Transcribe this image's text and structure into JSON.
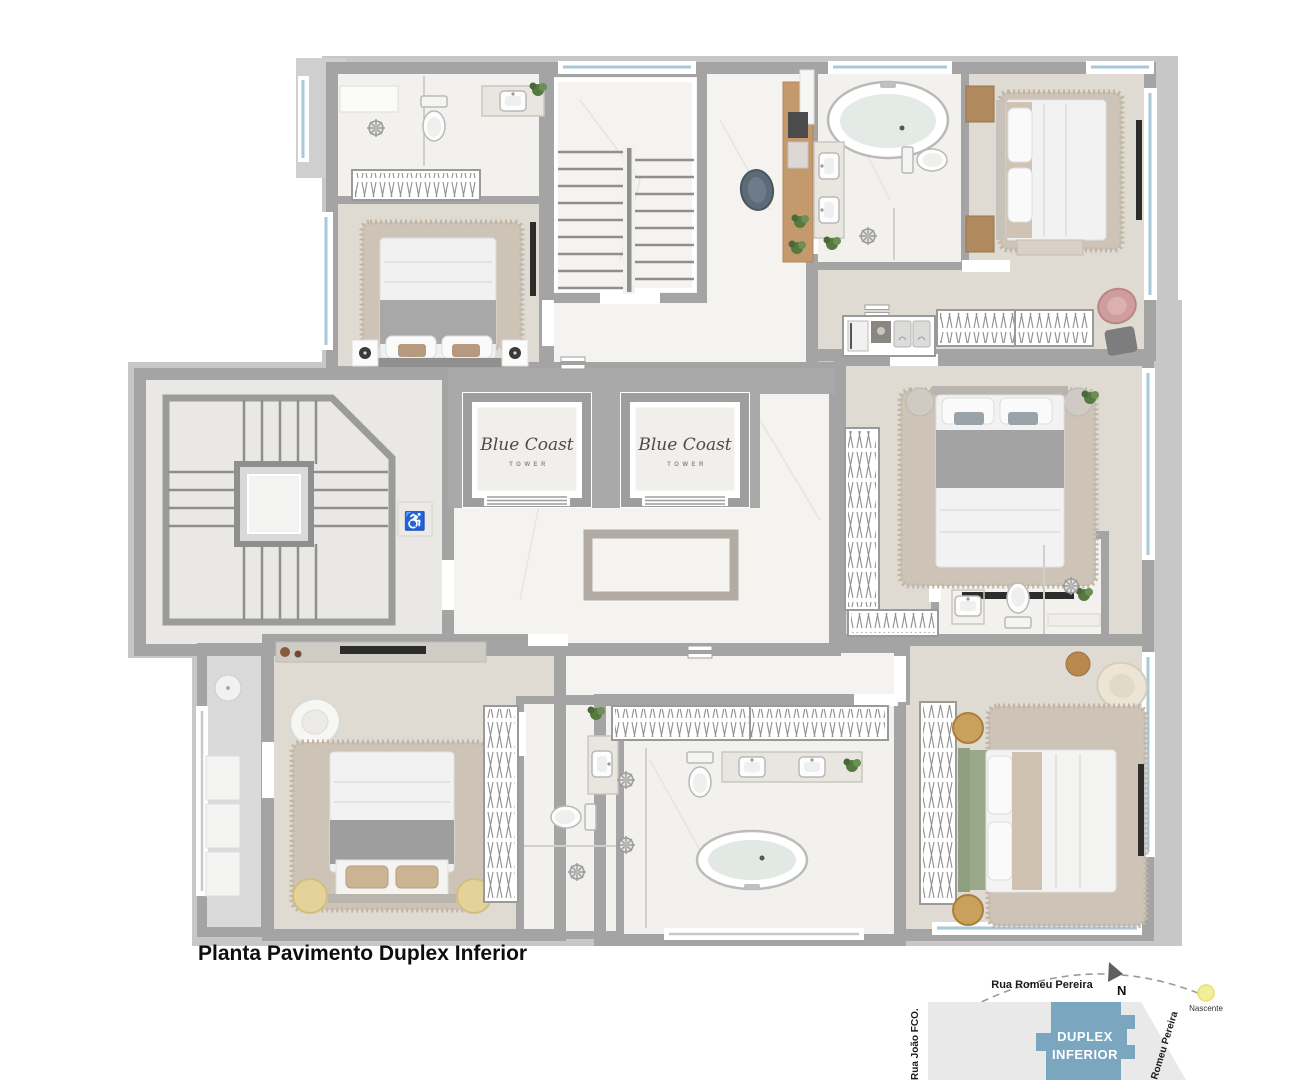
{
  "page": {
    "background": "#ffffff",
    "title": "Planta Pavimento Duplex Inferior"
  },
  "plan": {
    "elevators": [
      {
        "brand": "Blue Coast",
        "sub": "TOWER"
      },
      {
        "brand": "Blue Coast",
        "sub": "TOWER"
      }
    ],
    "colors": {
      "wall": "#a4a4a4",
      "silhouette": "#c7c7c7",
      "wood_floor": "#e0dbd2",
      "marble_floor": "#f3f1ed",
      "window": "#a9c8dc",
      "rug": "#cdc4b7"
    }
  },
  "minimap": {
    "street_top": "Rua Romeu Pereira",
    "street_left": "Rua João FCO.",
    "street_right": "Romeu Pereira",
    "north_label": "N",
    "sun_label": "Nascente",
    "building_label_line1": "DUPLEX",
    "building_label_line2": "INFERIOR",
    "building_color": "#7aa6c0",
    "lot_color": "#e9e9e9",
    "sun_color": "#f4ee9b"
  }
}
